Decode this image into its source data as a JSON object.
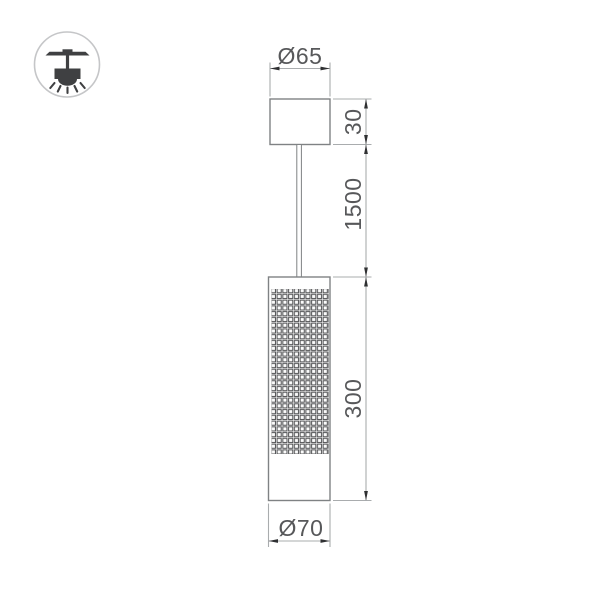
{
  "icon": {
    "name": "pendant-ceiling-light-icon"
  },
  "labels": {
    "canopy_diameter": "Ø65",
    "canopy_height": "30",
    "suspension_length": "1500",
    "body_height": "300",
    "body_diameter": "Ø70"
  },
  "colors": {
    "background": "#ffffff",
    "outline": "#7f8284",
    "dimension_lines": "#a9acae",
    "arrowheads": "#2f3032",
    "text": "#57585a",
    "mesh": "#4f5052",
    "icon": "#3f4042",
    "icon_circle": "#c5c6c8"
  }
}
